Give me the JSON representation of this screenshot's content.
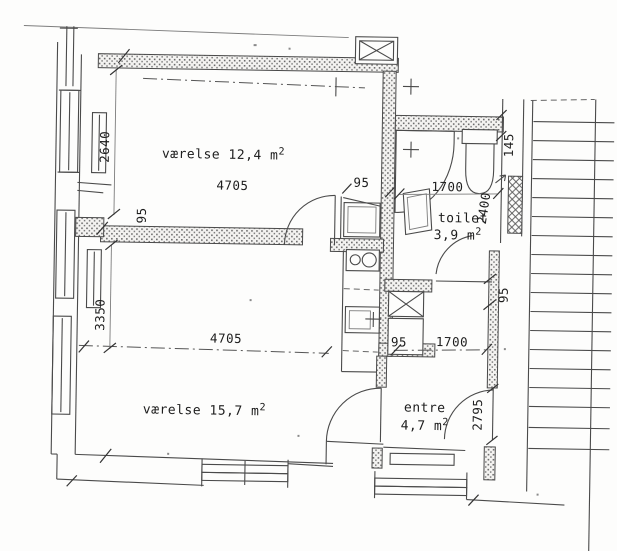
{
  "floor_plan": {
    "rooms": [
      {
        "id": "vaerelse-12",
        "label": "værelse 12,4 m",
        "sup": "2",
        "dim_below": "4705"
      },
      {
        "id": "vaerelse-15",
        "label": "værelse 15,7 m",
        "sup": "2"
      },
      {
        "id": "toilet",
        "label": "toilet",
        "area": "3,9 m",
        "sup": "2"
      },
      {
        "id": "entre",
        "label": "entre",
        "area": "4,7 m",
        "sup": "2"
      }
    ],
    "dimensions": {
      "d2640": "2640",
      "d95_left": "95",
      "d3350": "3350",
      "d4705_bottom": "4705",
      "d95_kitchen": "95",
      "d95_shaft": "95",
      "d1700_top": "1700",
      "d1700_bottom": "1700",
      "d2400": "2400",
      "d145": "145",
      "d95_right": "95",
      "d2795": "2795"
    }
  }
}
